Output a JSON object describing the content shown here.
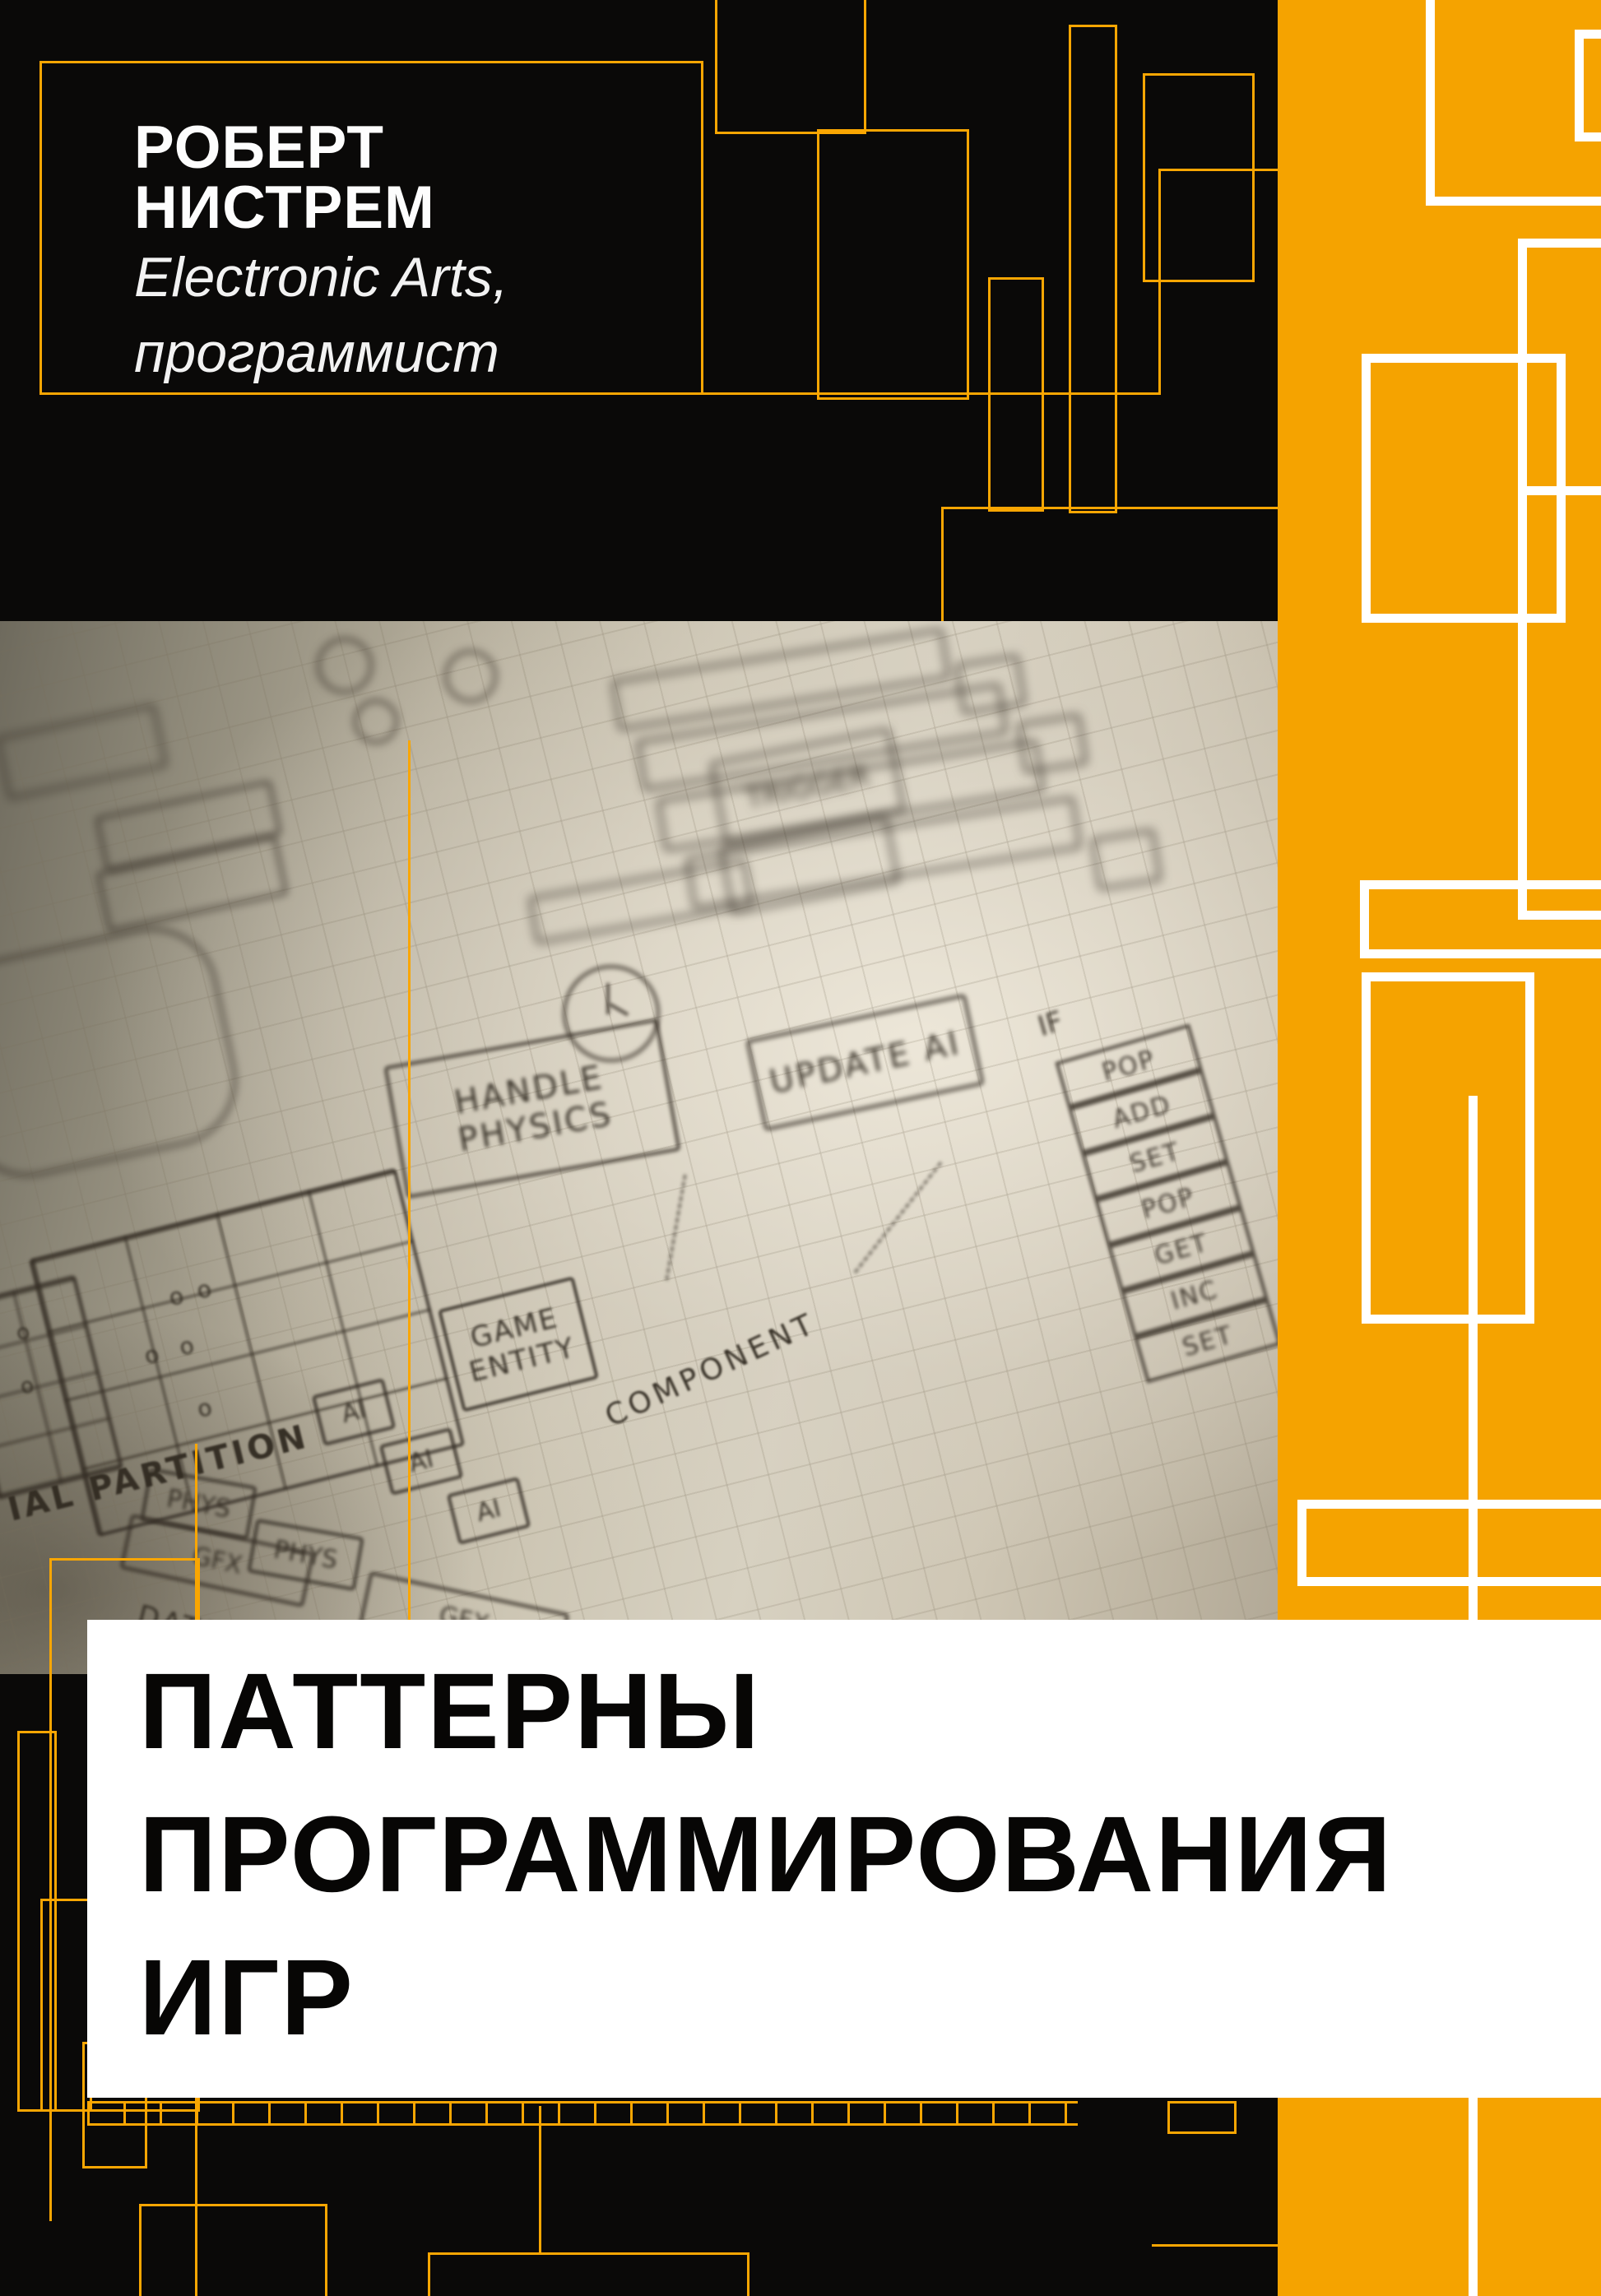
{
  "cover": {
    "author": {
      "name": "РОБЕРТ НИСТРЕМ",
      "affiliation": "Electronic Arts,",
      "role": "программист"
    },
    "title": {
      "line1": "ПАТТЕРНЫ",
      "line2": "ПРОГРАММИРОВАНИЯ",
      "line3": "ИГР"
    },
    "sketch": {
      "trigger": "TRIGGER",
      "update_ai": "UPDATE AI",
      "handle_physics": "HANDLE PHYSICS",
      "game_entity": "GAME ENTITY",
      "component": "COMPONENT",
      "partition": "IAL PARTITION",
      "data_loc": "DATA LOC",
      "if_label": "IF",
      "ai": "AI",
      "phys": "PHYS",
      "gfx": "GFX",
      "stack": [
        "POP",
        "ADD",
        "SET",
        "POP",
        "GET",
        "INC",
        "SET"
      ]
    },
    "colors": {
      "accent_orange": "#F5A300",
      "deco_line_orange": "#F9A602",
      "background_black": "#0A0908",
      "banner_white": "#FFFFFF",
      "title_ink": "#070605"
    }
  }
}
